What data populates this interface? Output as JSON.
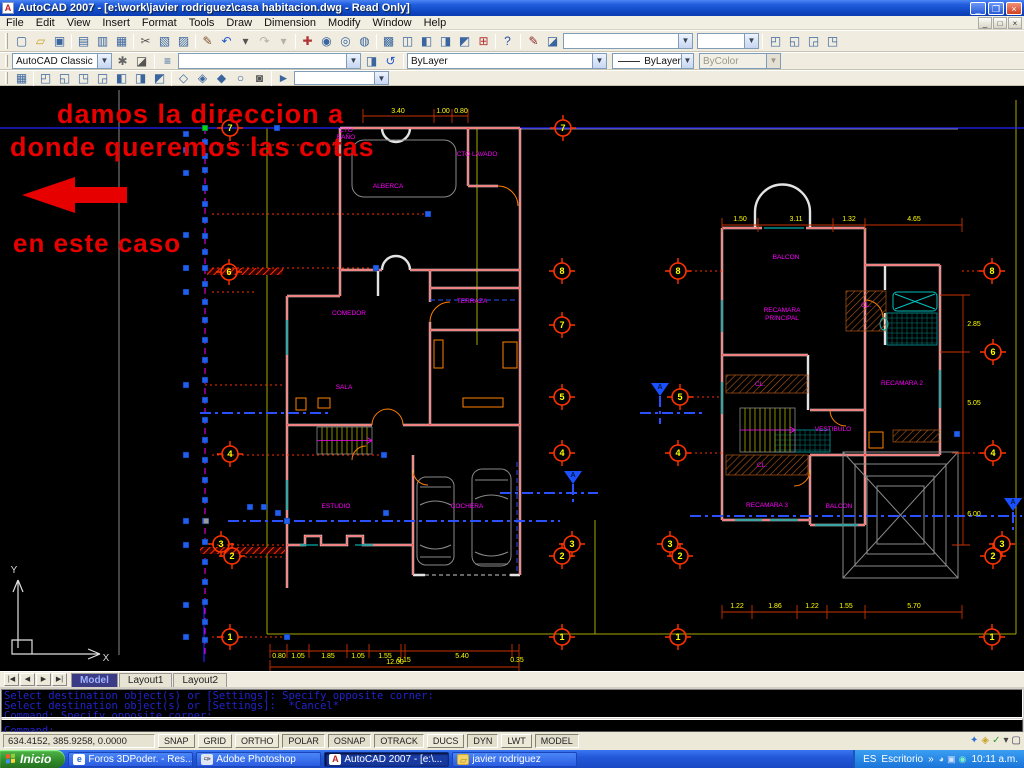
{
  "title": "AutoCAD 2007 - [e:\\work\\javier rodriguez\\casa habitacion.dwg - Read Only]",
  "window": {
    "minimize": "_",
    "restore": "❐",
    "close": "×"
  },
  "menus": [
    "File",
    "Edit",
    "View",
    "Ins0ert",
    "Format",
    "Tools",
    "Draw",
    "Dimension",
    "Modify",
    "Window",
    "Help"
  ],
  "toolbars": {
    "workspace": "AutoCAD Classic",
    "layer_value": "",
    "color": "ByLayer",
    "linetype": "ByLayer",
    "plotstyle": "ByColor",
    "std_icons": [
      {
        "n": "qnew-icon",
        "g": "▢"
      },
      {
        "n": "open-icon",
        "g": "▱",
        "c": "#c9a227"
      },
      {
        "n": "save-icon",
        "g": "▣"
      },
      {
        "n": "sep"
      },
      {
        "n": "plot-icon",
        "g": "▤"
      },
      {
        "n": "plot-preview-icon",
        "g": "▥"
      },
      {
        "n": "publish-icon",
        "g": "▦"
      },
      {
        "n": "sep"
      },
      {
        "n": "cut-icon",
        "g": "✂",
        "c": "#555"
      },
      {
        "n": "copy-icon",
        "g": "▧"
      },
      {
        "n": "paste-icon",
        "g": "▨"
      },
      {
        "n": "sep"
      },
      {
        "n": "match-properties-icon",
        "g": "✎",
        "c": "#7a5230"
      },
      {
        "n": "undo-icon",
        "g": "↶",
        "c": "#2255cc"
      },
      {
        "n": "undo-drop-icon",
        "g": "▾",
        "c": "#555"
      },
      {
        "n": "redo-icon",
        "g": "↷",
        "dis": 1
      },
      {
        "n": "redo-drop-icon",
        "g": "▾",
        "dis": 1
      },
      {
        "n": "sep"
      },
      {
        "n": "pan-icon",
        "g": "✚",
        "c": "#b23333"
      },
      {
        "n": "zoom-realtime-icon",
        "g": "◉"
      },
      {
        "n": "zoom-window-icon",
        "g": "◎"
      },
      {
        "n": "zoom-previous-icon",
        "g": "◍"
      },
      {
        "n": "sep"
      },
      {
        "n": "properties-icon",
        "g": "▩"
      },
      {
        "n": "designcenter-icon",
        "g": "◫"
      },
      {
        "n": "tool-palettes-icon",
        "g": "◧"
      },
      {
        "n": "sheetset-manager-icon",
        "g": "◨"
      },
      {
        "n": "markup-manager-icon",
        "g": "◩"
      },
      {
        "n": "quickcalc-icon",
        "g": "⊞",
        "c": "#b23333"
      },
      {
        "n": "sep"
      },
      {
        "n": "help-icon",
        "g": "?",
        "c": "#2a51a8"
      }
    ],
    "styles_icons": [
      {
        "n": "text-style-icon",
        "g": "✎",
        "c": "#8a2a2a"
      },
      {
        "n": "dim-style-icon",
        "g": "◪"
      }
    ],
    "viewport_icons": [
      {
        "n": "viewport-single-icon",
        "g": "◰"
      },
      {
        "n": "viewport-poly-icon",
        "g": "◱"
      },
      {
        "n": "viewport-join-icon",
        "g": "◲"
      },
      {
        "n": "viewport-clip-icon",
        "g": "◳"
      }
    ],
    "workspace_icons": [
      {
        "n": "workspace-settings-icon",
        "g": "✱",
        "c": "#666"
      },
      {
        "n": "my-workspace-icon",
        "g": "◪",
        "c": "#555"
      }
    ],
    "layer_icons_pre": [
      {
        "n": "layer-properties-icon",
        "g": "≡",
        "c": "#3a659e"
      }
    ],
    "layer_icons_post": [
      {
        "n": "layer-states-icon",
        "g": "◨"
      },
      {
        "n": "layer-previous-icon",
        "g": "↺",
        "c": "#2255cc"
      }
    ],
    "view_icons": [
      {
        "n": "named-views-icon",
        "g": "▦"
      },
      {
        "n": "sep"
      },
      {
        "n": "view-top-icon",
        "g": "◰"
      },
      {
        "n": "view-bottom-icon",
        "g": "◱"
      },
      {
        "n": "view-left-icon",
        "g": "◳"
      },
      {
        "n": "view-right-icon",
        "g": "◲"
      },
      {
        "n": "view-front-icon",
        "g": "◧"
      },
      {
        "n": "view-back-icon",
        "g": "◨"
      },
      {
        "n": "view-swiso-icon",
        "g": "◩"
      },
      {
        "n": "sep"
      },
      {
        "n": "orbit-constrained-icon",
        "g": "◇"
      },
      {
        "n": "orbit-free-icon",
        "g": "◈"
      },
      {
        "n": "orbit-continuous-icon",
        "g": "◆"
      },
      {
        "n": "orbit-reset-icon",
        "g": "○"
      },
      {
        "n": "camera-icon",
        "g": "◙",
        "c": "#555"
      },
      {
        "n": "sep"
      },
      {
        "n": "show-motion-icon",
        "g": "►",
        "c": "#3a659e"
      }
    ]
  },
  "annotation": {
    "color": "#e60000",
    "arrow": "22,195 75,177 75,187 127,187 127,203 75,203 75,213",
    "lines": [
      {
        "t": "damos la direccion a",
        "x": 57,
        "y": 123,
        "s": 27
      },
      {
        "t": "donde queremos las cotas",
        "x": 10,
        "y": 156,
        "s": 27
      },
      {
        "t": "en este caso",
        "x": 13,
        "y": 252,
        "s": 26
      }
    ]
  },
  "drawing": {
    "colors": {
      "label": "#ff00ff",
      "dim_text": "#ffff00",
      "bubble": "#ff3200",
      "bubble_text": "#ffff00",
      "grip": "#2060f0",
      "grip_green": "#00dd00",
      "grip_gray": "#9a9a9a",
      "marker": "#1a50ff"
    },
    "labels": [
      {
        "t": "CTO",
        "x": 346,
        "y": 132
      },
      {
        "t": "BAÑO",
        "x": 346,
        "y": 139
      },
      {
        "t": "ALBERCA",
        "x": 388,
        "y": 188
      },
      {
        "t": "CTO LAVADO",
        "x": 477,
        "y": 156
      },
      {
        "t": "TERRAZA",
        "x": 472,
        "y": 303
      },
      {
        "t": "COMEDOR",
        "x": 349,
        "y": 315
      },
      {
        "t": "SALA",
        "x": 344,
        "y": 389
      },
      {
        "t": "ESTUDIO",
        "x": 336,
        "y": 508
      },
      {
        "t": "COCHERA",
        "x": 467,
        "y": 508
      },
      {
        "t": "BALCON",
        "x": 786,
        "y": 259
      },
      {
        "t": "RECAMARA",
        "x": 782,
        "y": 312
      },
      {
        "t": "PRINCIPAL",
        "x": 782,
        "y": 320
      },
      {
        "t": "CL.",
        "x": 866,
        "y": 307
      },
      {
        "t": "CL.",
        "x": 760,
        "y": 386
      },
      {
        "t": "RECAMARA 2",
        "x": 902,
        "y": 385
      },
      {
        "t": "VESTIBULO",
        "x": 833,
        "y": 431
      },
      {
        "t": "CL.",
        "x": 762,
        "y": 467
      },
      {
        "t": "RECAMARA 3",
        "x": 767,
        "y": 507
      },
      {
        "t": "BALCON",
        "x": 839,
        "y": 508
      },
      {
        "t": "Y",
        "x": 14,
        "y": 573,
        "c": "#d9d9d9",
        "s": 10
      },
      {
        "t": "X",
        "x": 106,
        "y": 661,
        "c": "#d9d9d9",
        "s": 10
      }
    ],
    "dims": [
      {
        "t": "3.40",
        "x": 398,
        "y": 113
      },
      {
        "t": "1.00",
        "x": 443,
        "y": 113
      },
      {
        "t": "0.80",
        "x": 461,
        "y": 113
      },
      {
        "t": "0.80",
        "x": 279,
        "y": 658
      },
      {
        "t": "1.05",
        "x": 298,
        "y": 658
      },
      {
        "t": "1.85",
        "x": 328,
        "y": 658
      },
      {
        "t": "1.05",
        "x": 358,
        "y": 658
      },
      {
        "t": "1.55",
        "x": 385,
        "y": 658
      },
      {
        "t": "0.15",
        "x": 404,
        "y": 662
      },
      {
        "t": "5.40",
        "x": 462,
        "y": 658
      },
      {
        "t": "0.35",
        "x": 517,
        "y": 662
      },
      {
        "t": "12.00",
        "x": 395,
        "y": 664
      },
      {
        "t": "1.50",
        "x": 740,
        "y": 221
      },
      {
        "t": "3.11",
        "x": 796,
        "y": 221
      },
      {
        "t": "1.32",
        "x": 849,
        "y": 221
      },
      {
        "t": "4.65",
        "x": 914,
        "y": 221
      },
      {
        "t": "1.22",
        "x": 737,
        "y": 608
      },
      {
        "t": "1.86",
        "x": 775,
        "y": 608
      },
      {
        "t": "1.22",
        "x": 812,
        "y": 608
      },
      {
        "t": "1.55",
        "x": 846,
        "y": 608
      },
      {
        "t": "5.70",
        "x": 914,
        "y": 608
      },
      {
        "t": "2.85",
        "x": 974,
        "y": 326
      },
      {
        "t": "5.05",
        "x": 974,
        "y": 405
      },
      {
        "t": "6.00",
        "x": 974,
        "y": 516
      }
    ],
    "bubbles": [
      {
        "n": "7",
        "x": 230,
        "y": 128
      },
      {
        "n": "6",
        "x": 229,
        "y": 272
      },
      {
        "n": "4",
        "x": 230,
        "y": 454
      },
      {
        "n": "3",
        "x": 221,
        "y": 544
      },
      {
        "n": "2",
        "x": 232,
        "y": 556
      },
      {
        "n": "1",
        "x": 230,
        "y": 637
      },
      {
        "n": "7",
        "x": 563,
        "y": 128
      },
      {
        "n": "8",
        "x": 562,
        "y": 271
      },
      {
        "n": "7",
        "x": 562,
        "y": 325
      },
      {
        "n": "5",
        "x": 562,
        "y": 397
      },
      {
        "n": "4",
        "x": 562,
        "y": 453
      },
      {
        "n": "3",
        "x": 572,
        "y": 544
      },
      {
        "n": "2",
        "x": 562,
        "y": 556
      },
      {
        "n": "1",
        "x": 562,
        "y": 637
      },
      {
        "n": "8",
        "x": 678,
        "y": 271
      },
      {
        "n": "5",
        "x": 680,
        "y": 397
      },
      {
        "n": "4",
        "x": 678,
        "y": 453
      },
      {
        "n": "3",
        "x": 670,
        "y": 544
      },
      {
        "n": "2",
        "x": 680,
        "y": 556
      },
      {
        "n": "1",
        "x": 678,
        "y": 637
      },
      {
        "n": "8",
        "x": 992,
        "y": 271
      },
      {
        "n": "6",
        "x": 993,
        "y": 352
      },
      {
        "n": "4",
        "x": 993,
        "y": 453
      },
      {
        "n": "3",
        "x": 1002,
        "y": 544
      },
      {
        "n": "2",
        "x": 993,
        "y": 556
      },
      {
        "n": "1",
        "x": 992,
        "y": 637
      }
    ],
    "grips_main_x": 205,
    "grips_main_y": [
      142,
      156,
      170,
      188,
      204,
      220,
      236,
      252,
      268,
      284,
      302,
      320,
      340,
      360,
      380,
      400,
      420,
      440,
      460,
      480,
      500,
      521,
      542,
      562,
      582,
      602,
      622,
      640
    ],
    "grips_outer": [
      [
        186,
        134
      ],
      [
        186,
        150
      ],
      [
        186,
        173
      ],
      [
        186,
        235
      ],
      [
        186,
        268
      ],
      [
        186,
        292
      ],
      [
        186,
        385
      ],
      [
        186,
        455
      ],
      [
        186,
        521
      ],
      [
        186,
        545
      ],
      [
        186,
        605
      ],
      [
        186,
        637
      ]
    ],
    "grips_plan": [
      [
        277,
        128
      ],
      [
        428,
        214
      ],
      [
        376,
        268
      ],
      [
        384,
        455
      ],
      [
        250,
        507
      ],
      [
        264,
        507
      ],
      [
        278,
        513
      ],
      [
        386,
        513
      ],
      [
        287,
        521
      ],
      [
        287,
        637
      ],
      [
        957,
        434
      ]
    ],
    "grip_green": [
      205,
      128
    ],
    "grip_gray": [
      206,
      521
    ],
    "dotted": [
      [
        145,
        212,
        340
      ],
      [
        214,
        212,
        424
      ],
      [
        268,
        212,
        370
      ],
      [
        292,
        212,
        254
      ],
      [
        385,
        205,
        284
      ],
      [
        455,
        212,
        380
      ],
      [
        545,
        212,
        284
      ],
      [
        557,
        240,
        284
      ],
      [
        637,
        212,
        226
      ],
      [
        637,
        240,
        286
      ],
      [
        271,
        690,
        722
      ],
      [
        397,
        692,
        722
      ],
      [
        453,
        690,
        722
      ],
      [
        271,
        962,
        980
      ],
      [
        453,
        958,
        981
      ]
    ],
    "dashdot": [
      [
        200,
        413,
        332,
        413
      ],
      [
        640,
        413,
        702,
        413
      ],
      [
        228,
        521,
        560,
        521
      ],
      [
        690,
        516,
        1022,
        516
      ],
      [
        500,
        493,
        598,
        493
      ],
      [
        660,
        396,
        660,
        424
      ],
      [
        573,
        484,
        573,
        506
      ],
      [
        1013,
        512,
        1013,
        534
      ]
    ],
    "markers": [
      [
        660,
        388
      ],
      [
        573,
        476
      ],
      [
        1013,
        503
      ]
    ],
    "marker_letter": "A",
    "stairs": [
      [
        317,
        427,
        55,
        27
      ],
      [
        740,
        408,
        55,
        44
      ]
    ],
    "hatch_red": [
      [
        207,
        268,
        76,
        7
      ],
      [
        200,
        547,
        85,
        7
      ]
    ],
    "hatch_brown": [
      [
        726,
        375,
        82,
        18
      ],
      [
        726,
        455,
        82,
        20
      ],
      [
        846,
        291,
        40,
        40
      ],
      [
        893,
        430,
        47,
        12
      ]
    ],
    "tiles": [
      [
        887,
        313,
        50,
        32
      ],
      [
        775,
        430,
        55,
        22
      ]
    ],
    "furniture": [
      [
        503,
        342,
        14,
        26
      ],
      [
        463,
        398,
        40,
        9
      ],
      [
        434,
        340,
        9,
        28
      ],
      [
        296,
        398,
        10,
        12
      ],
      [
        318,
        398,
        12,
        10
      ],
      [
        869,
        432,
        14,
        16
      ]
    ]
  },
  "tabs": [
    {
      "label": "Model",
      "active": true
    },
    {
      "label": "Layout1",
      "active": false
    },
    {
      "label": "Layout2",
      "active": false
    }
  ],
  "command": {
    "history": [
      "Select destination object(s) or [Settings]: Specify opposite corner:",
      "Select destination object(s) or [Settings]:  *Cancel*",
      "Command: Specify opposite corner:"
    ],
    "prompt": "Command:"
  },
  "status": {
    "coords": "634.4152, 385.9258, 0.0000",
    "toggles": [
      {
        "label": "SNAP",
        "on": false
      },
      {
        "label": "GRID",
        "on": false
      },
      {
        "label": "ORTHO",
        "on": false
      },
      {
        "label": "POLAR",
        "on": true
      },
      {
        "label": "OSNAP",
        "on": true
      },
      {
        "label": "OTRACK",
        "on": true
      },
      {
        "label": "DUCS",
        "on": false
      },
      {
        "label": "DYN",
        "on": true
      },
      {
        "label": "LWT",
        "on": false
      },
      {
        "label": "MODEL",
        "on": true
      }
    ],
    "tray_icons": [
      {
        "n": "communication-center-icon",
        "g": "✦",
        "c": "#2a6fd6"
      },
      {
        "n": "toolbar-lock-icon",
        "g": "◈",
        "c": "#c9a227"
      },
      {
        "n": "associated-files-icon",
        "g": "✓",
        "c": "#2f9e2f"
      },
      {
        "n": "status-tray-arrow-icon",
        "g": "▾",
        "c": "#444"
      },
      {
        "n": "clean-screen-icon",
        "g": "▢",
        "c": "#335"
      }
    ]
  },
  "taskbar": {
    "start": "Inicio",
    "tasks": [
      {
        "label": "Foros 3DPoder. - Res...",
        "icon": "ie",
        "iglyph": "e",
        "active": false
      },
      {
        "label": "Adobe Photoshop",
        "icon": "ps",
        "iglyph": "✑",
        "active": false
      },
      {
        "label": "AutoCAD 2007 - [e:\\...",
        "icon": "acad",
        "iglyph": "A",
        "active": true
      },
      {
        "label": "javier rodriguez",
        "icon": "folder",
        "iglyph": "▱",
        "active": false
      }
    ],
    "tray": {
      "lang": "ES",
      "desktop": "Escritorio",
      "chevron": "»",
      "clock": "10:11 a.m.",
      "icons": [
        {
          "n": "tray-volume-icon",
          "g": "◕",
          "c": "#d8e4f8"
        },
        {
          "n": "tray-network-icon",
          "g": "▣",
          "c": "#cfe0ff"
        },
        {
          "n": "tray-msn-icon",
          "g": "◉",
          "c": "#7af0c8"
        }
      ]
    }
  }
}
